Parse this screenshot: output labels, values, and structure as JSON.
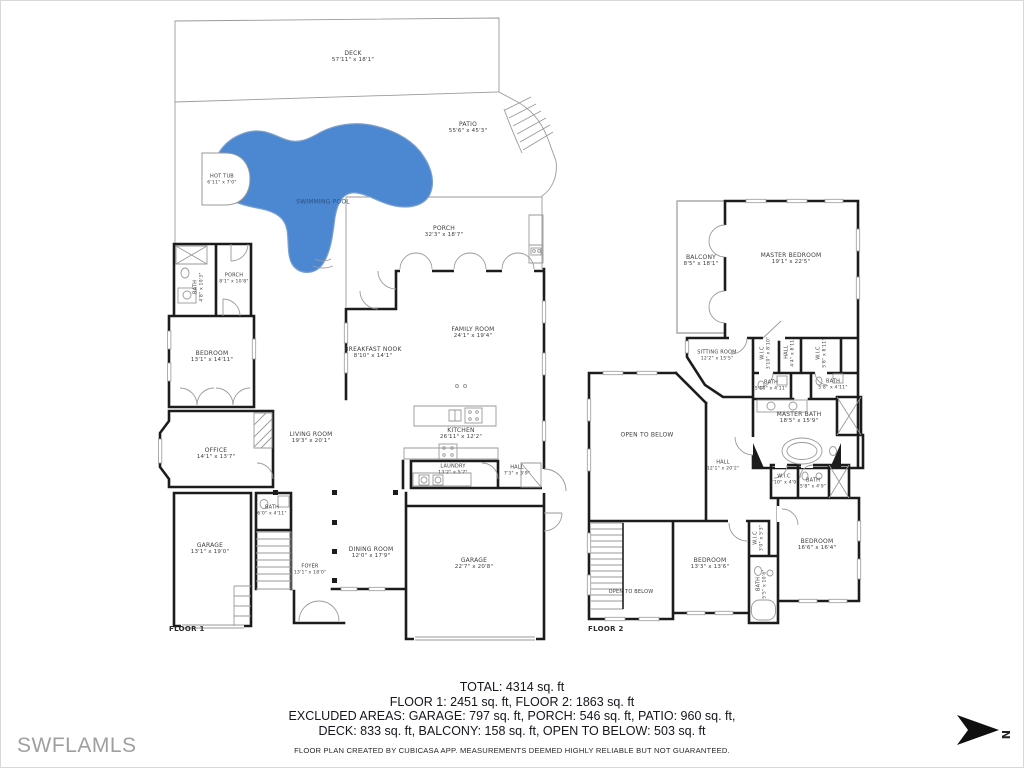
{
  "page": {
    "watermark": "SWFLAMLS",
    "compass_label": "N",
    "summary": {
      "line1": "TOTAL: 4314 sq. ft",
      "line2": "FLOOR 1: 2451 sq. ft, FLOOR 2: 1863 sq. ft",
      "line3": "EXCLUDED AREAS: GARAGE: 797 sq. ft, PORCH: 546 sq. ft, PATIO: 960 sq. ft,",
      "line4": "DECK: 833 sq. ft, BALCONY: 158 sq. ft, OPEN TO BELOW: 503 sq. ft",
      "disclaimer": "FLOOR PLAN CREATED BY CUBICASA APP. MEASUREMENTS DEEMED HIGHLY RELIABLE BUT NOT GUARANTEED."
    },
    "colors": {
      "pool": "#4c87d2",
      "wall": "#1c1c1c",
      "thin_line": "#9a9a9a"
    }
  },
  "floor1": {
    "label": "FLOOR 1",
    "rooms": {
      "deck": {
        "name": "DECK",
        "dims": "57'11\" x 18'1\""
      },
      "patio": {
        "name": "PATIO",
        "dims": "55'6\" x 45'3\""
      },
      "hot_tub": {
        "name": "HOT TUB",
        "dims": "6'11\" x 7'0\""
      },
      "pool": {
        "name": "SWIMMING POOL"
      },
      "porch_rear": {
        "name": "PORCH",
        "dims": "32'3\" x 18'7\""
      },
      "porch_small": {
        "name": "PORCH",
        "dims": "8'1\" x 10'8\""
      },
      "bath_upper": {
        "name": "BATH",
        "dims": "4'8\" x 10'3\""
      },
      "bedroom": {
        "name": "BEDROOM",
        "dims": "13'1\" x 14'11\""
      },
      "breakfast_nook": {
        "name": "BREAKFAST NOOK",
        "dims": "8'10\" x 14'1\""
      },
      "family_room": {
        "name": "FAMILY ROOM",
        "dims": "24'1\" x 19'4\""
      },
      "office": {
        "name": "OFFICE",
        "dims": "14'1\" x 13'7\""
      },
      "living_room": {
        "name": "LIVING ROOM",
        "dims": "19'3\" x 20'1\""
      },
      "kitchen": {
        "name": "KITCHEN",
        "dims": "26'11\" x 12'2\""
      },
      "laundry": {
        "name": "LAUNDRY",
        "dims": "13'2\" x 5'7\""
      },
      "hall": {
        "name": "HALL",
        "dims": "7'3\" x 3'9\""
      },
      "bath_small": {
        "name": "BATH",
        "dims": "6'0\" x 4'11\""
      },
      "garage_small": {
        "name": "GARAGE",
        "dims": "13'1\" x 19'0\""
      },
      "foyer": {
        "name": "FOYER",
        "dims": "13'1\" x 18'0\""
      },
      "dining_room": {
        "name": "DINING ROOM",
        "dims": "12'0\" x 17'9\""
      },
      "garage_big": {
        "name": "GARAGE",
        "dims": "22'7\" x 20'8\""
      }
    }
  },
  "floor2": {
    "label": "FLOOR 2",
    "rooms": {
      "balcony": {
        "name": "BALCONY",
        "dims": "8'5\" x 18'1\""
      },
      "master_bedroom": {
        "name": "MASTER BEDROOM",
        "dims": "19'1\" x 22'5\""
      },
      "sitting_room": {
        "name": "SITTING ROOM",
        "dims": "12'2\" x 15'5\""
      },
      "wic_left": {
        "name": "W.I.C",
        "dims": "3'10\" x 8'10\""
      },
      "hall_upper": {
        "name": "HALL",
        "dims": "4'4\" x 8'11\""
      },
      "wic_right": {
        "name": "W.I.C",
        "dims": "5'8\" x 8'11\""
      },
      "bath_left": {
        "name": "BATH",
        "dims": "5'10\" x 4'11\""
      },
      "bath_right": {
        "name": "BATH",
        "dims": "5'8\" x 4'11\""
      },
      "master_bath": {
        "name": "MASTER BATH",
        "dims": "18'5\" x 15'9\""
      },
      "open_below_upper": {
        "name": "OPEN TO BELOW"
      },
      "hall2": {
        "name": "HALL",
        "dims": "12'1\" x 20'2\""
      },
      "wic_small": {
        "name": "W.I.C",
        "dims": "3'10\" x 4'9\""
      },
      "bath_mid": {
        "name": "BATH",
        "dims": "5'8\" x 4'9\""
      },
      "bedroom3": {
        "name": "BEDROOM",
        "dims": "13'3\" x 13'6\""
      },
      "wic_tiny": {
        "name": "W.I.C",
        "dims": "3'0\" x 5'3\""
      },
      "bedroom4": {
        "name": "BEDROOM",
        "dims": "16'6\" x 16'4\""
      },
      "bath_bottom": {
        "name": "BATH",
        "dims": "5'5\" x 10'6\""
      },
      "open_below_lower": {
        "name": "OPEN TO BELOW"
      }
    }
  }
}
